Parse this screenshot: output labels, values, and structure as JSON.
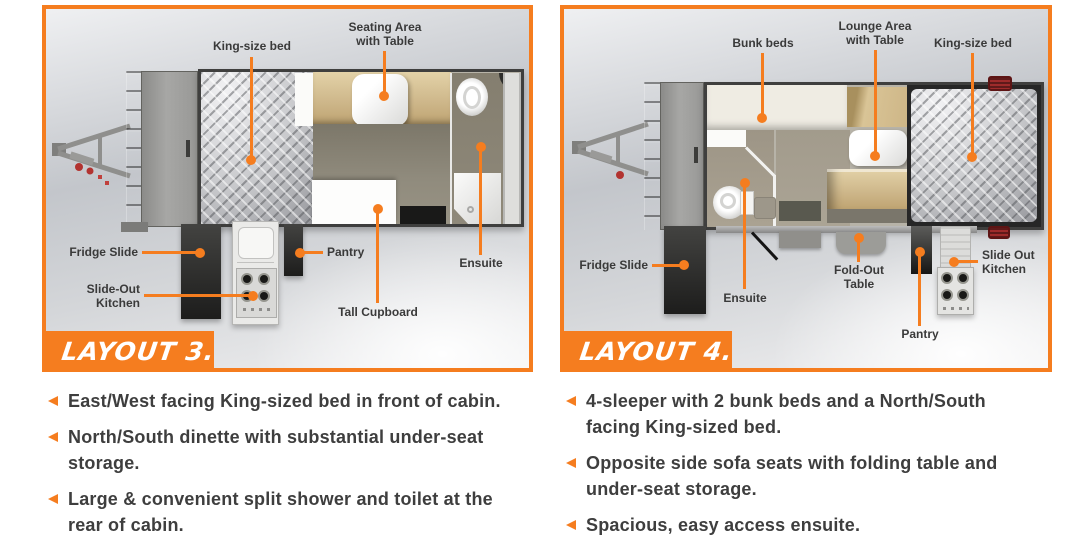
{
  "accent": "#f57d1f",
  "text_color": "#3e3e3e",
  "panels": [
    {
      "banner": "LAYOUT 3.",
      "callouts": {
        "king_bed": "King-size bed",
        "seating": "Seating Area with Table",
        "fridge": "Fridge Slide",
        "kitchen": "Slide-Out Kitchen",
        "pantry": "Pantry",
        "cupboard": "Tall Cupboard",
        "ensuite": "Ensuite"
      },
      "bullets": [
        "East/West facing King-sized bed in front of cabin.",
        "North/South dinette with substantial under-seat storage.",
        "Large & convenient split shower and toilet at the rear of cabin."
      ]
    },
    {
      "banner": "LAYOUT 4.",
      "callouts": {
        "bunks": "Bunk beds",
        "lounge": "Lounge Area with Table",
        "king_bed": "King-size bed",
        "fridge": "Fridge Slide",
        "ensuite": "Ensuite",
        "fold_table": "Fold-Out Table",
        "pantry": "Pantry",
        "kitchen": "Slide Out Kitchen"
      },
      "bullets": [
        "4-sleeper with 2 bunk beds and a North/South facing King-sized bed.",
        "Opposite side sofa seats with folding table and under-seat storage.",
        "Spacious, easy access ensuite."
      ]
    }
  ]
}
